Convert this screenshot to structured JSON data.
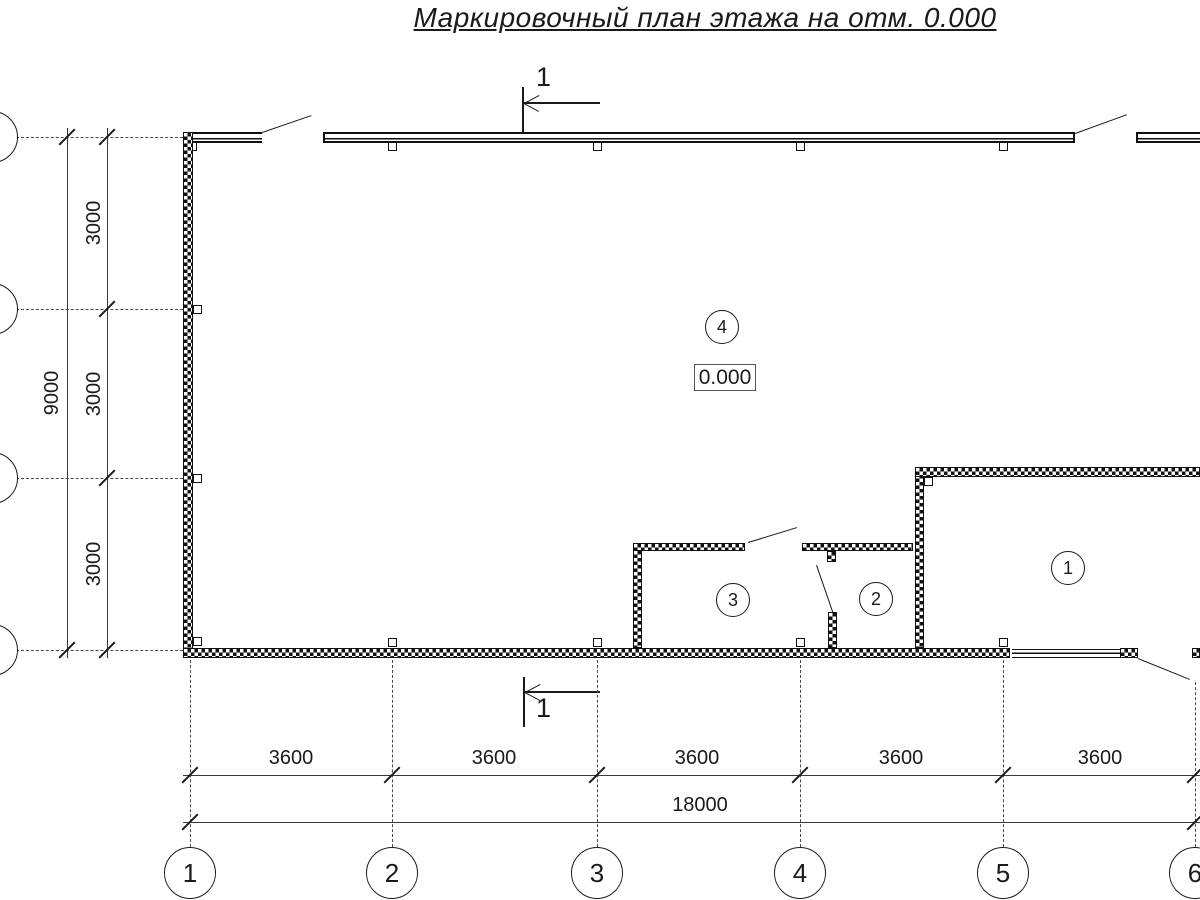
{
  "title": "Маркировочный план этажа на отм. 0.000",
  "colors": {
    "ink": "#1a1a1a",
    "paper": "#ffffff"
  },
  "section_mark": {
    "top_label": "1",
    "bottom_label": "1"
  },
  "elevation": "0.000",
  "rooms": {
    "r1": "1",
    "r2": "2",
    "r3": "3",
    "r4": "4"
  },
  "axes_bottom": [
    "1",
    "2",
    "3",
    "4",
    "5",
    "6"
  ],
  "dims_bottom": {
    "segments": [
      "3600",
      "3600",
      "3600",
      "3600",
      "3600"
    ],
    "total": "18000"
  },
  "dims_left": {
    "segments": [
      "3000",
      "3000",
      "3000"
    ],
    "total": "9000"
  }
}
